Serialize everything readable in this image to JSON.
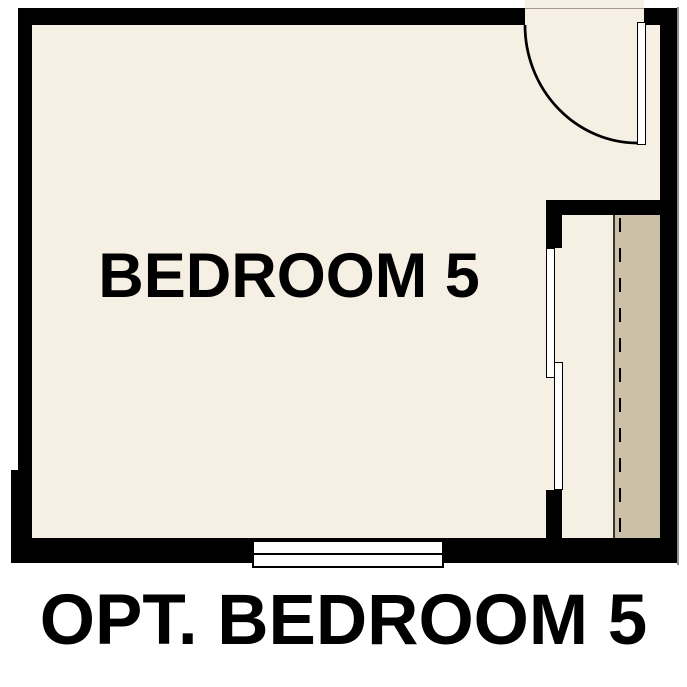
{
  "labels": {
    "room": "BEDROOM 5",
    "caption": "OPT. BEDROOM 5"
  },
  "colors": {
    "wall": "#000000",
    "floor": "#f6efe4",
    "shelf": "#cbc0a7",
    "fixture": "#ffffff",
    "text": "#000000",
    "background": "#ffffff",
    "shelf-edge": "#38332c",
    "header-line": "#a39a8c",
    "edge-shadow": "#8f8f8f"
  }
}
